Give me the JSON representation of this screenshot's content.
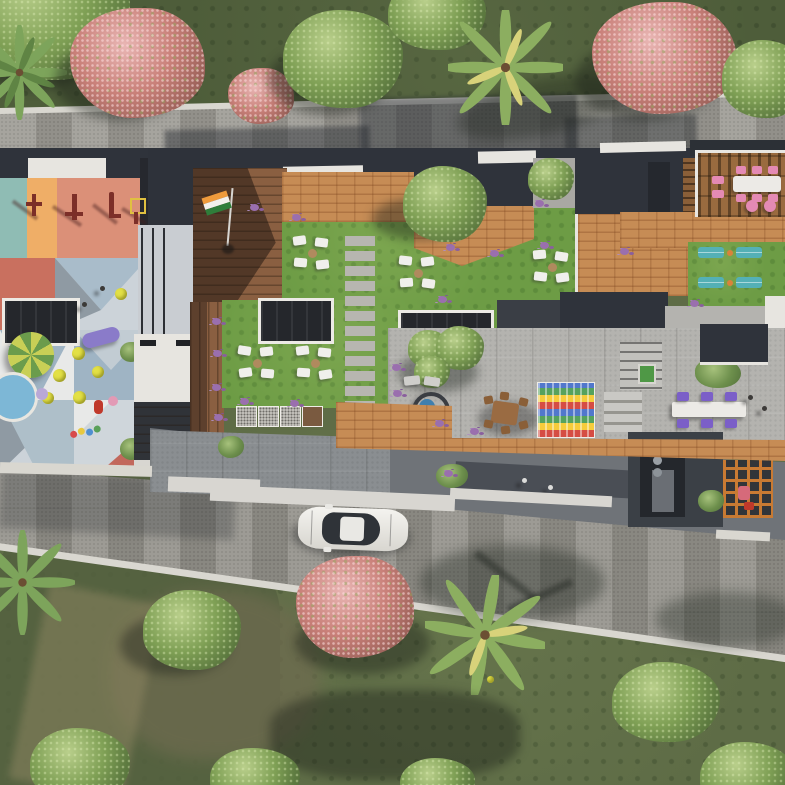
{
  "scene": {
    "title": "Aerial top-down 3D render of a residential rooftop amenity podium with playground, lawns, decks and perimeter roads",
    "view": "top-down",
    "style": "photorealistic architectural render"
  },
  "palette": {
    "grass_perimeter": "#4e5d3a",
    "grass_bottom": "#5e6c46",
    "grass_bottom_dark": "#53603f",
    "grass_patch_brown": "#6e6b4f",
    "lawn_green": "#6d9c45",
    "road_paver": "#9e9c96",
    "road_lower": "#95938c",
    "curb_white": "#d9d7d0",
    "parapet_white": "#e7e5e0",
    "wall_light": "#d8d6d1",
    "dark_roof": "#2f333b",
    "mid_roof": "#565b62",
    "roof_slab": "#6f7378",
    "stair_panel": "#c9cdd2",
    "terrace_paver": "#b4b3af",
    "deck_wood": "#8a5f41",
    "brick_path": "#c68c55",
    "gym_teal": "#8fbcb4",
    "gym_orange": "#efae67",
    "gym_salmon": "#db9078",
    "skylight_dark": "#25272c",
    "pool_blue": "#7db7d6",
    "table_blue": "#3f7fae",
    "flag_saffron": "#ef9b3c",
    "flag_white": "#f2f0ec",
    "flag_green": "#2f7d3a",
    "trellis_orange": "#c87a33"
  },
  "zones": {
    "perimeter_top": "lawn strip with green trees, flowering pink trees and palms",
    "road_top": "grey paver driveway with building shadows",
    "kids_gym": "outdoor gym strip in teal, orange and salmon with exercise machines",
    "play_floor": "geometric multi-colour play floor with trampolines, parasol, kiddie pool, slide and toys",
    "flag_deck": "timber deck with national flag pole",
    "central_lawn": "lawn with stepping-stone path, five lounger clusters and skylights",
    "plaza": "brick paved plaza and roof structures",
    "pergola": "timber pergola dining with pink chairs and white table",
    "yoga_lawn": "lawn with four teal yoga mats and exercise balls",
    "terrace": "grey terrace with blue cafe table, timber dining set, colourful play mat, steps and purple-chair table",
    "service_roofs": "lower grey roofs, walkway, orange trellis frames",
    "road_bottom": "wide paver driveway with one white sedan",
    "perimeter_bottom": "large lawn with palms, green and pink trees"
  },
  "objects": {
    "vehicle": "white sedan, roof view",
    "flag": "India tricolor on deck pole",
    "lounger_clusters": 5,
    "yoga_mats": 4,
    "pink_chairs": 8,
    "purple_chairs": 6,
    "trampolines": 6,
    "mosaic_panels": 4,
    "skylights": 3,
    "people": 6
  }
}
